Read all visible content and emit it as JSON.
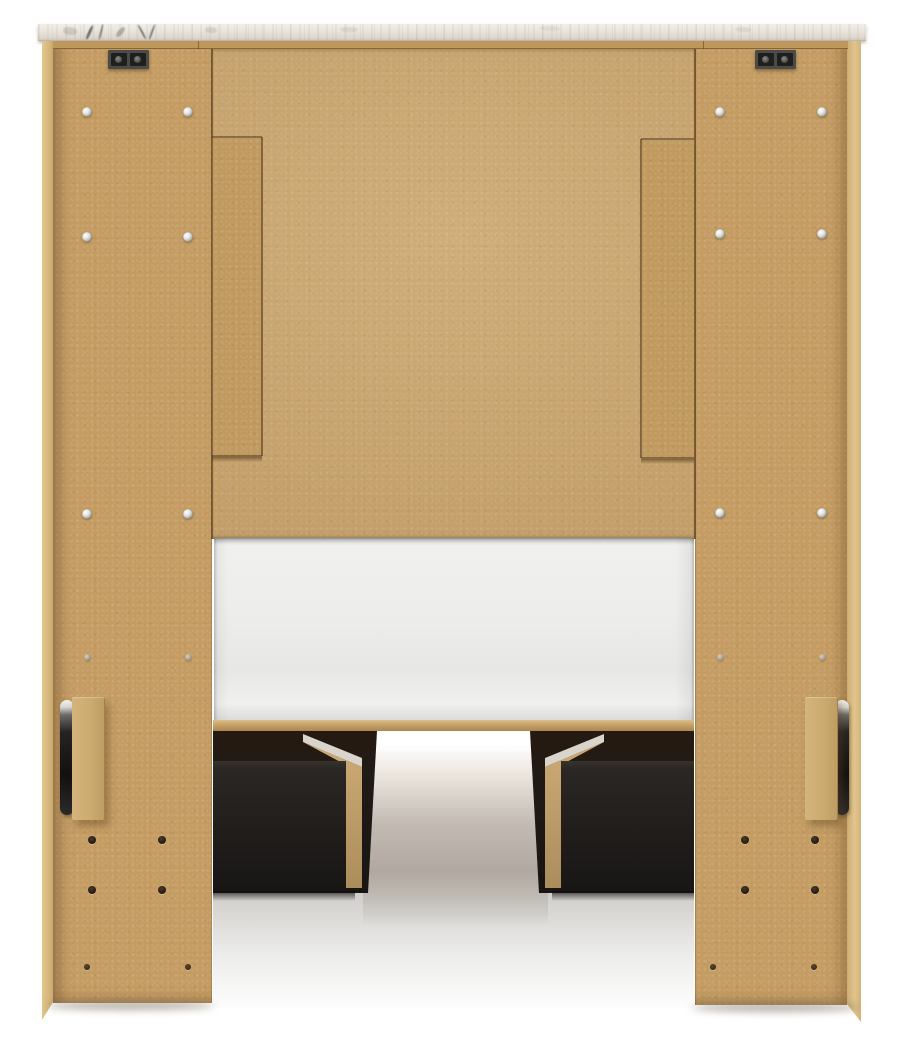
{
  "meta": {
    "alt": "Back view product photo of a natural-finish panel storage bed: marble-look top cap, tan MDF back panels with assembly screws, white mattress platform, two black under-bed storage drawers, black side handles, white studio background"
  },
  "colors": {
    "bg": "#ffffff",
    "mdf-panel": "#c9a46c",
    "mdf-leg": "#c49c63",
    "mdf-stile": "#c0995f",
    "mdf-edge": "#d9bd86",
    "mdf-rail": "#bd975c",
    "marble-hi": "#f2eee7",
    "marble-lo": "#cfc9bf",
    "vein": "#4e4e4c",
    "plate": "#4c4b48",
    "slot": "#1f1f1e",
    "drawer": "#211e1c",
    "underbed": "#1d150e",
    "partition-wood": "#c3a26d",
    "partition-edge": "#d9d5cc",
    "platform": "#ececea",
    "floor": "#b3ada7",
    "handle": "#2b2b2b",
    "hole": "#2a2013",
    "screw": "#e5e5e3"
  },
  "hardware": {
    "screws_silver": [
      [
        87,
        112
      ],
      [
        188,
        112
      ],
      [
        87,
        237
      ],
      [
        188,
        237
      ],
      [
        87,
        514
      ],
      [
        188,
        514
      ],
      [
        720,
        112
      ],
      [
        822,
        112
      ],
      [
        720,
        234
      ],
      [
        822,
        234
      ],
      [
        720,
        513
      ],
      [
        822,
        513
      ]
    ],
    "screws_faint": [
      [
        87,
        657
      ],
      [
        188,
        657
      ],
      [
        720,
        657
      ],
      [
        822,
        657
      ]
    ],
    "holes_dark": [
      [
        92,
        840
      ],
      [
        162,
        840
      ],
      [
        92,
        890
      ],
      [
        162,
        890
      ],
      [
        745,
        840
      ],
      [
        815,
        840
      ],
      [
        745,
        890
      ],
      [
        815,
        890
      ]
    ],
    "holes_small": [
      [
        87,
        967
      ],
      [
        188,
        967
      ],
      [
        713,
        967
      ],
      [
        814,
        967
      ]
    ]
  },
  "marble_veins": [
    {
      "x": 88,
      "y": 25,
      "w": 3,
      "h": 15,
      "rot": 24,
      "o": 0.75
    },
    {
      "x": 100,
      "y": 24,
      "w": 2,
      "h": 16,
      "rot": 14,
      "o": 0.6
    },
    {
      "x": 118,
      "y": 26,
      "w": 5,
      "h": 12,
      "rot": 40,
      "o": 0.35
    },
    {
      "x": 141,
      "y": 24,
      "w": 2,
      "h": 16,
      "rot": -28,
      "o": 0.7
    },
    {
      "x": 151,
      "y": 24,
      "w": 2,
      "h": 16,
      "rot": 20,
      "o": 0.65
    },
    {
      "x": 63,
      "y": 27,
      "w": 14,
      "h": 8,
      "rot": 8,
      "o": 0.18
    },
    {
      "x": 205,
      "y": 27,
      "w": 12,
      "h": 6,
      "rot": 4,
      "o": 0.14
    },
    {
      "x": 340,
      "y": 27,
      "w": 18,
      "h": 5,
      "rot": 2,
      "o": 0.1
    },
    {
      "x": 540,
      "y": 26,
      "w": 20,
      "h": 5,
      "rot": 2,
      "o": 0.08
    },
    {
      "x": 735,
      "y": 27,
      "w": 16,
      "h": 5,
      "rot": 3,
      "o": 0.09
    }
  ]
}
